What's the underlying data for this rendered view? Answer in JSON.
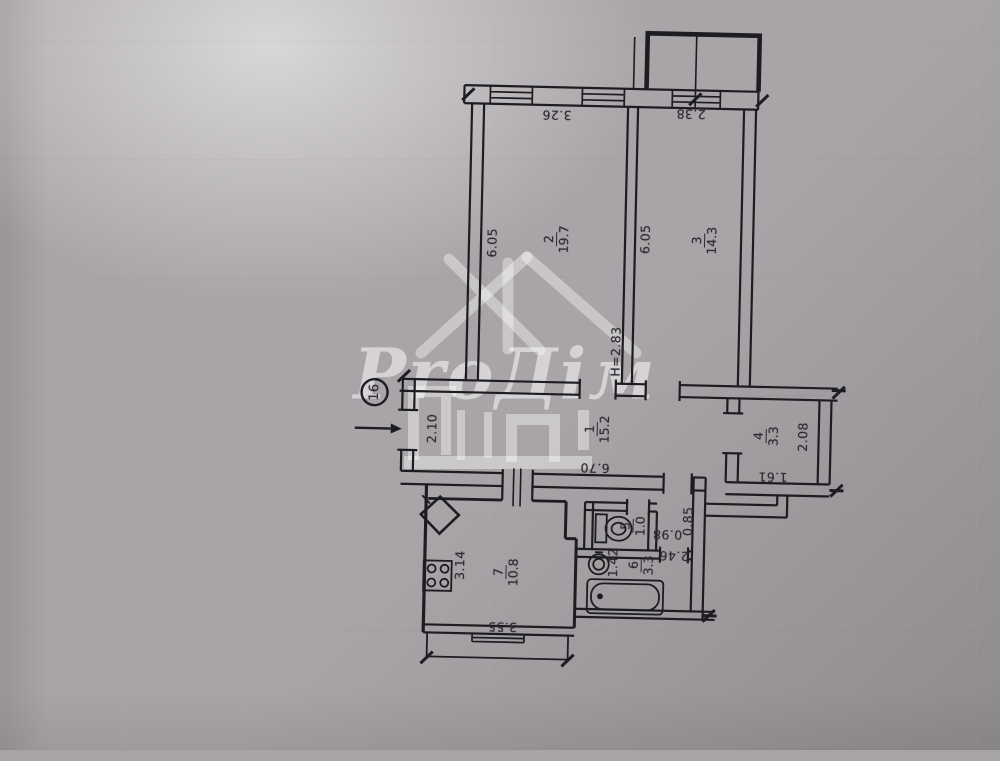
{
  "watermark": {
    "brand": "ProДім"
  },
  "entrance": {
    "badge": "16"
  },
  "height_note": "H=2.83",
  "rooms": {
    "r1": {
      "number": "1",
      "area": "15.2"
    },
    "r2": {
      "number": "2",
      "area": "19.7"
    },
    "r3": {
      "number": "3",
      "area": "14.3"
    },
    "r4": {
      "number": "4",
      "area": "3.3"
    },
    "r5": {
      "number": "5",
      "area": "1.0"
    },
    "r6": {
      "number": "6",
      "area": "3.3"
    },
    "r7": {
      "number": "7",
      "area": "10.8"
    }
  },
  "dims": {
    "top_left": "3.26",
    "top_right": "2.38",
    "side_r2": "6.05",
    "side_r3": "6.05",
    "hall_entry": "2.10",
    "hall_length": "6.70",
    "r4_height": "2.08",
    "r4_width": "1.61",
    "niche": "0.85",
    "wc_width": "0.98",
    "bath_length": "2.46",
    "bath_width": "1.42",
    "kitchen_width": "3.14",
    "kitchen_length": "3.55"
  },
  "colors": {
    "line": "#1d1c21",
    "paper": "#a8a4a7",
    "watermark": "#ffffff"
  }
}
